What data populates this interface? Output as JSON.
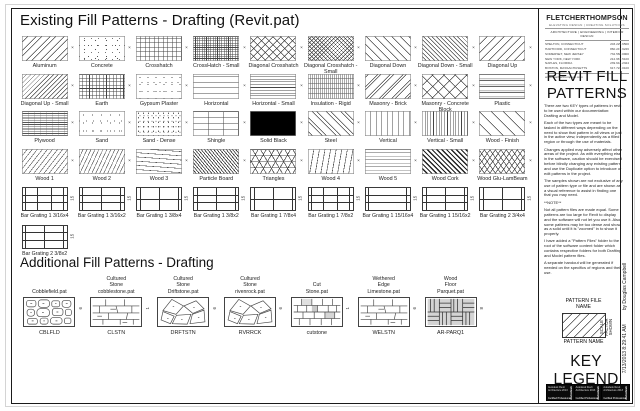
{
  "sheet": {
    "title_existing": "Existing Fill Patterns - Drafting (Revit.pat)",
    "title_additional": "Additional Fill Patterns - Drafting"
  },
  "patterns": [
    {
      "label": "Aluminum",
      "type": "aluminum",
      "scale": "×"
    },
    {
      "label": "Concrete",
      "type": "concrete",
      "scale": "×"
    },
    {
      "label": "Crosshatch",
      "type": "crosshatch",
      "scale": "×"
    },
    {
      "label": "CrossHatch - Small",
      "type": "crosshatch-sm",
      "scale": "×"
    },
    {
      "label": "Diagonal Crosshatch",
      "type": "diagx",
      "scale": "×"
    },
    {
      "label": "Diagonal Crosshatch - Small",
      "type": "diagx-sm",
      "scale": "×"
    },
    {
      "label": "Diagonal Down",
      "type": "diagdown",
      "scale": "×"
    },
    {
      "label": "Diagonal Down - Small",
      "type": "diagdown-sm",
      "scale": "×"
    },
    {
      "label": "Diagonal Up",
      "type": "diagup",
      "scale": "×"
    },
    {
      "label": "Diagonal Up - Small",
      "type": "diagup-sm",
      "scale": "×"
    },
    {
      "label": "Earth",
      "type": "earth",
      "scale": "×"
    },
    {
      "label": "Gypsum Plaster",
      "type": "plaster",
      "scale": "×"
    },
    {
      "label": "Horizontal",
      "type": "horiz",
      "scale": "×"
    },
    {
      "label": "Horizontal - Small",
      "type": "horiz-sm",
      "scale": "×"
    },
    {
      "label": "Insulation - Rigid",
      "type": "insul",
      "scale": "×"
    },
    {
      "label": "Masonry - Brick",
      "type": "brick",
      "scale": "×"
    },
    {
      "label": "Masonry - Concrete Block",
      "type": "block",
      "scale": "×"
    },
    {
      "label": "Plastic",
      "type": "plastic",
      "scale": "×"
    },
    {
      "label": "Plywood",
      "type": "plywood",
      "scale": "×"
    },
    {
      "label": "Sand",
      "type": "sand",
      "scale": "×"
    },
    {
      "label": "Sand - Dense",
      "type": "sand-dense",
      "scale": "×"
    },
    {
      "label": "Shingle",
      "type": "shingle",
      "scale": "×"
    },
    {
      "label": "Solid Black",
      "type": "solid",
      "scale": "×"
    },
    {
      "label": "Steel",
      "type": "steel",
      "scale": "×"
    },
    {
      "label": "Vertical",
      "type": "vert",
      "scale": "×"
    },
    {
      "label": "Vertical - Small",
      "type": "vert-sm",
      "scale": "×"
    },
    {
      "label": "Wood - Finish",
      "type": "woodfin",
      "scale": "×"
    },
    {
      "label": "Wood 1",
      "type": "wood1",
      "scale": "×"
    },
    {
      "label": "Wood 2",
      "type": "wood2",
      "scale": "×"
    },
    {
      "label": "Wood 3",
      "type": "wood3",
      "scale": "×"
    },
    {
      "label": "Particle Board",
      "type": "particle",
      "scale": "×"
    },
    {
      "label": "Triangles",
      "type": "triangles",
      "scale": "×"
    },
    {
      "label": "Wood 4",
      "type": "wood4",
      "scale": "×"
    },
    {
      "label": "Wood 5",
      "type": "wood5",
      "scale": "×"
    },
    {
      "label": "Wood Cork",
      "type": "cork",
      "scale": "×"
    },
    {
      "label": "Wood Glu-LamBeam",
      "type": "glulam",
      "scale": "×"
    }
  ],
  "bar_gratings": [
    {
      "label": "Bar Grating 1 3/16x4",
      "scale": "15",
      "h": 2,
      "v": 2
    },
    {
      "label": "Bar Grating 1 3/16x2",
      "scale": "15",
      "h": 2,
      "v": 1
    },
    {
      "label": "Bar Grating 1 3/8x4",
      "scale": "15",
      "h": 1,
      "v": 1
    },
    {
      "label": "Bar Grating 1 3/8x2",
      "scale": "15",
      "h": 2,
      "v": 1
    },
    {
      "label": "Bar Grating 1 7/8x4",
      "scale": "15",
      "h": 1,
      "v": 1
    },
    {
      "label": "Bar Grating 1 7/8x2",
      "scale": "15",
      "h": 2,
      "v": 2
    },
    {
      "label": "Bar Grating 1 15/16x4",
      "scale": "15",
      "h": 2,
      "v": 0
    },
    {
      "label": "Bar Grating 1 15/16x2",
      "scale": "15",
      "h": 2,
      "v": 1
    },
    {
      "label": "Bar Grating 2 3/4x4",
      "scale": "15",
      "h": 1,
      "v": 1
    },
    {
      "label": "Bar Grating 2 3/8x2",
      "scale": "15",
      "h": 2,
      "v": 1
    }
  ],
  "additional_patterns": [
    {
      "name": [
        "Cobblefield.pat"
      ],
      "label": "CBLFLD",
      "type": "rubble",
      "scale": "6"
    },
    {
      "name": [
        "Cultured",
        "Stone",
        "cobblestone.pat"
      ],
      "label": "CLSTN",
      "type": "slabs",
      "scale": "1"
    },
    {
      "name": [
        "Cultured",
        "Stone",
        "Driftstone.pat"
      ],
      "label": "DRFTSTN",
      "type": "polys",
      "scale": "6"
    },
    {
      "name": [
        "Cultured",
        "Stone",
        "rivenrock.pat"
      ],
      "label": "RVRRCK",
      "type": "polys",
      "scale": "6"
    },
    {
      "name": [
        "Cut",
        "Stone.pat"
      ],
      "label": "cutstone",
      "type": "ashlar",
      "scale": "1"
    },
    {
      "name": [
        "Wethered",
        "Edge",
        "Limestone.pat"
      ],
      "label": "WELSTN",
      "type": "slabs",
      "scale": "6"
    },
    {
      "name": [
        "Wood",
        "Floor",
        "Parquet.pat"
      ],
      "label": "AR-PARQ1",
      "type": "parquet",
      "scale": "8"
    }
  ],
  "sidebar": {
    "brand": "FLETCHERTHOMPSON",
    "tagline": "ELEVATING DESIGN | CREATING SOLUTIONS",
    "services": "ARCHITECTURE | ENGINEERING | INTERIOR DESIGN",
    "offices": [
      {
        "city": "SHELTON, CONNECTICUT",
        "phone": "203.225.6500"
      },
      {
        "city": "HARTFORD, CONNECTICUT",
        "phone": "860.247.9226"
      },
      {
        "city": "SOMERSET, NEW JERSEY",
        "phone": "732.560.0900"
      },
      {
        "city": "NEW YORK, NEW YORK",
        "phone": "212.967.5100"
      },
      {
        "city": "NAPLES, FLORIDA",
        "phone": "239.643.2324"
      },
      {
        "city": "BOSTON, MASSACHUSETTS",
        "phone": "617.722.0100"
      }
    ],
    "website": "www.fletcherthompson.com",
    "doc_title": "REVIT FILL PATTERNS",
    "paragraphs": [
      "There are two KEY types of patterns in revit to be used within our documentation: Drafting and Model.",
      "Each of the two types are meant to be tasked in different ways depending on the need to show that pattern in all views or just in the active view, independently as a filled region or through the use of materials.",
      "Changes applied may adversely affect other areas of the project. As with everything else in the software, caution should be exercised before blindly changing any existing pattern and use the Duplicate option to introduce or edit patterns in the project.",
      "The samples shown are not exclusive of any use of pattern type or file and are shown as a visual reference to assist in finding one that you may need.",
      "**NOTE**",
      "Not all pattern files are made equal.  Some patterns are too large for Revit to display and the software will not let you use it.  Also, some patterns may be too dense and show as a solid until it is \"zoomed\" in to show it properly.",
      "I have added a \"Pattern Files\" folder to the root of the software content folder which contains respective folders for both Drafting and Model pattern files.",
      "A separate handout will be generated if needed on the specifics of regions and their use."
    ],
    "key": {
      "file_label": "PATTERN FILE NAME",
      "name_label": "PATTERN NAME",
      "scale_label": "SCALE FACTOR SHOWN",
      "legend_title": "KEY LEGEND"
    },
    "badges": [
      {
        "product": "Autodesk Revit Architecture 2013",
        "cert": "Certified Professional",
        "brand": "Autodesk"
      },
      {
        "product": "Autodesk Revit Architecture 2013",
        "cert": "Certified Professional",
        "brand": "Autodesk"
      },
      {
        "product": "Autodesk Revit Architecture 2013",
        "cert": "Certified Professional",
        "brand": "Autodesk"
      }
    ],
    "footer_stamp": "7/13/2013 8:29:41 AM",
    "footer_author": "by Douglas Campbell"
  }
}
